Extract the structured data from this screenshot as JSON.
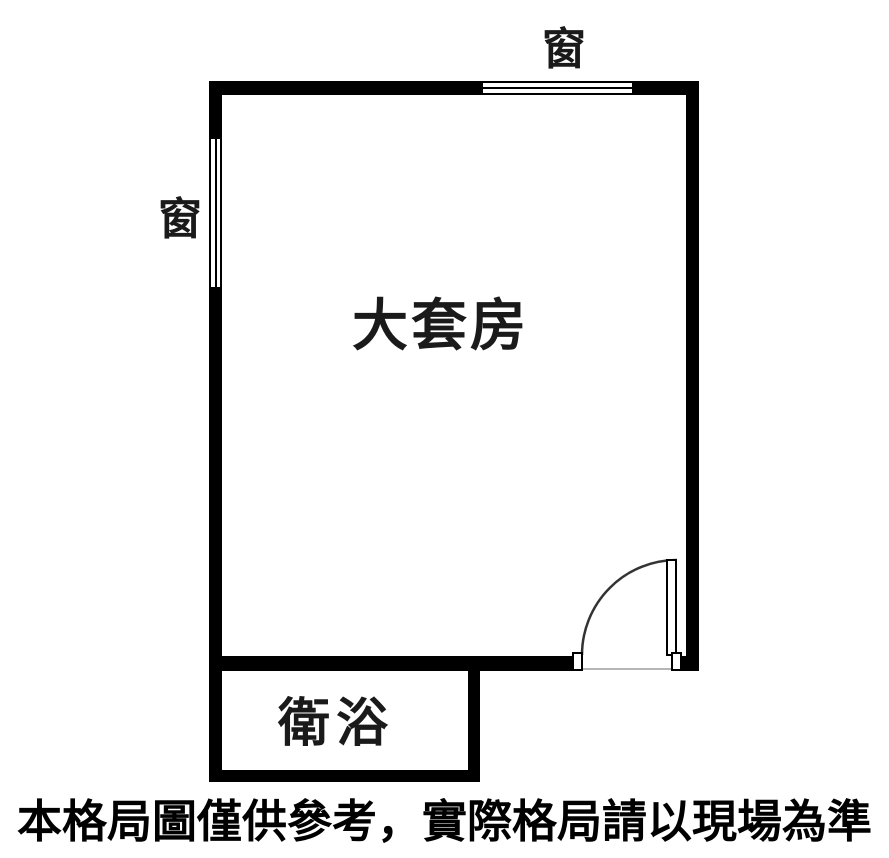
{
  "figure": {
    "type": "floor-plan",
    "background_color": "#ffffff",
    "wall_color": "#000000",
    "label_color": "#1a1a1a",
    "threshold_color": "#b5b5b5"
  },
  "rooms": [
    {
      "id": "main-room",
      "label": "大套房"
    },
    {
      "id": "bathroom",
      "label": "衛浴"
    }
  ],
  "windows": [
    {
      "id": "window-top",
      "wall": "top",
      "label": "窗"
    },
    {
      "id": "window-left",
      "wall": "left",
      "label": "窗"
    }
  ],
  "door": {
    "location": "bottom-right",
    "type": "single-swing",
    "swing": "quarter-arc"
  },
  "disclaimer": "本格局圖僅供參考，實際格局請以現場為準"
}
